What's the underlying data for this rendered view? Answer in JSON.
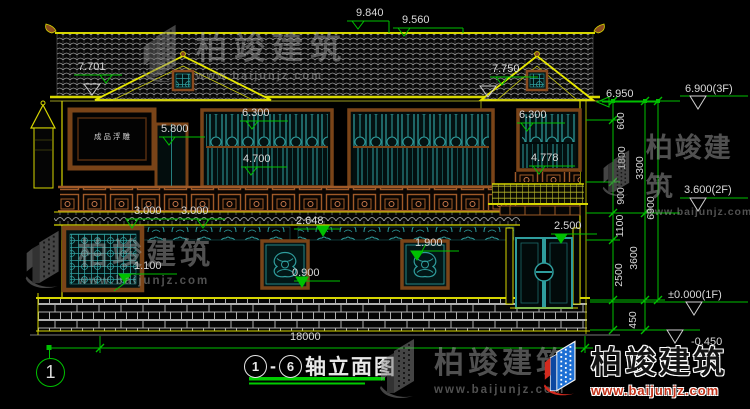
{
  "watermark": {
    "brand": "柏竣建筑",
    "url": "www.baijunjz.com"
  },
  "logo": {
    "brand": "柏竣建筑",
    "url": "www.baijunjz.com"
  },
  "title_block": {
    "axis_start": "1",
    "dash": "-",
    "axis_end": "6",
    "name": "轴立面图"
  },
  "axis_bubble": {
    "label": "1"
  },
  "building": {
    "relief_label": "成品浮雕"
  },
  "dims": {
    "top_a": "9.840",
    "top_b": "9.560",
    "gable_left": "7.701",
    "gable_right": "7.750",
    "eave_right": "6.950",
    "level_3f": "6.900(3F)",
    "win_left": "6.300",
    "win_right": "6.300",
    "door_2f": "5.800",
    "win_mid": "4.700",
    "win_wing": "4.778",
    "bay_a": "3.000",
    "bay_b": "3.000",
    "strip": "2.648",
    "door_1f": "2.500",
    "win1_b": "1.900",
    "win1_left": "1.100",
    "win1_a": "0.900",
    "level_2f": "3.600(2F)",
    "level_1f": "±0.000(1F)",
    "level_ground": "-0.450",
    "total_width": "18000",
    "v600": "600",
    "v1800": "1800",
    "v900": "900",
    "v3300": "3300",
    "v1100": "1100",
    "v2500": "2500",
    "v3600": "3600",
    "v6900": "6900",
    "v450": "450"
  },
  "colors": {
    "background": "#000000",
    "outline_yellow": "#d6d600",
    "dimension_green": "#00c000",
    "window_cyan": "#2f9d9d",
    "frame_brown": "#8a4a1f",
    "text_white": "#d9d9d9",
    "logo_blue": "#1d6fd4",
    "logo_red": "#d42a1e"
  }
}
